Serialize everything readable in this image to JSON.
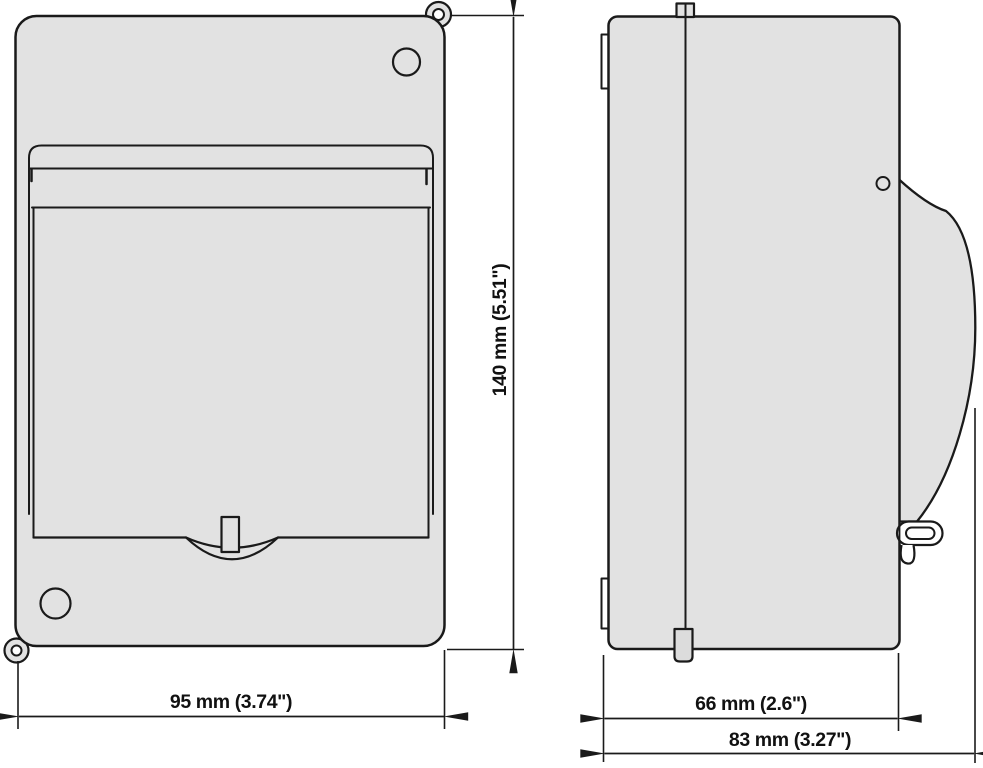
{
  "dimensions": {
    "front_width": {
      "label": "95 mm (3.74\")",
      "mm": 95,
      "inch": 3.74
    },
    "front_height": {
      "label": "140 mm (5.51\")",
      "mm": 140,
      "inch": 5.51
    },
    "side_depth_body": {
      "label": "66 mm (2.6\")",
      "mm": 66,
      "inch": 2.6
    },
    "side_depth_total": {
      "label": "83 mm (3.27\")",
      "mm": 83,
      "inch": 3.27
    }
  },
  "colors": {
    "outline": "#1a1a1a",
    "body-fill": "#e2e2e2",
    "tab-fill": "#dcdcdc",
    "background": "#ffffff",
    "dim-line": "#1a1a1a"
  }
}
